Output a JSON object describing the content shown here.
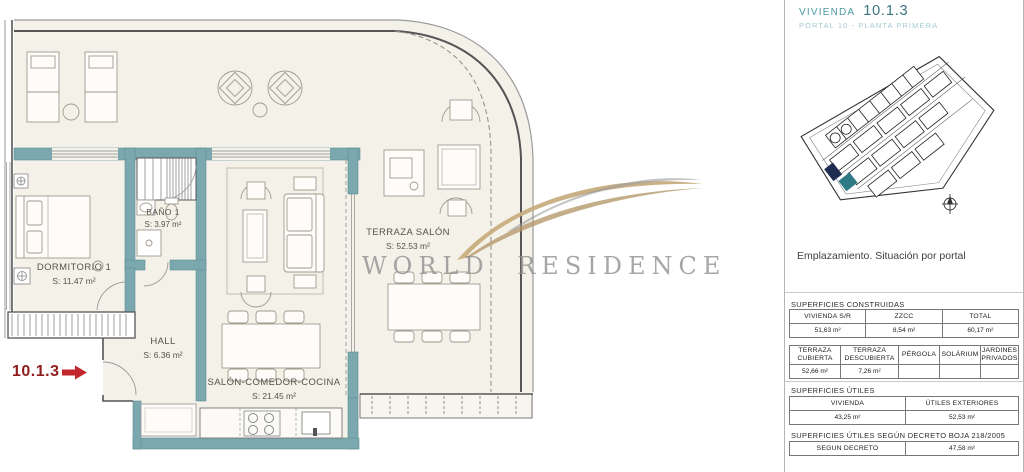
{
  "header": {
    "title_label": "VIVIENDA",
    "unit_number": "10.1.3",
    "subtitle": "PORTAL 10 - PLANTA PRIMERA"
  },
  "site_map": {
    "caption": "Emplazamiento. Situación por portal"
  },
  "surfaces": {
    "construidas": {
      "heading": "SUPERFICIES CONSTRUIDAS",
      "main": {
        "headers": [
          "VIVIENDA S/R",
          "ZZCC",
          "TOTAL"
        ],
        "values": [
          "51,63 m²",
          "8,54 m²",
          "60,17 m²"
        ]
      },
      "exterior": {
        "headers": [
          "TERRAZA CUBIERTA",
          "TERRAZA DESCUBIERTA",
          "PÉRGOLA",
          "SOLÁRIUM",
          "JARDINES PRIVADOS"
        ],
        "values": [
          "52,66 m²",
          "7,26 m²",
          "",
          "",
          ""
        ]
      }
    },
    "utiles": {
      "heading": "SUPERFICIES ÚTILES",
      "table": {
        "headers": [
          "VIVIENDA",
          "ÚTILES EXTERIORES"
        ],
        "values": [
          "43,25 m²",
          "52,53 m²"
        ]
      }
    },
    "decreto": {
      "heading": "SUPERFICIES ÚTILES SEGÚN DECRETO BOJA 218/2005",
      "table": {
        "headers": [
          "SEGUN DECRETO"
        ],
        "values": [
          "47,58 m²"
        ]
      }
    }
  },
  "plan": {
    "unit_label": "10.1.3",
    "rooms": [
      {
        "name": "DORMITORIO 1",
        "area": "S: 11.47 m²"
      },
      {
        "name": "BAÑO 1",
        "area": "S: 3.97 m²"
      },
      {
        "name": "HALL",
        "area": "S: 6.36 m²"
      },
      {
        "name": "SALÓN-COMEDOR-COCINA",
        "area": "S: 21.45 m²"
      },
      {
        "name": "TERRAZA SALÓN",
        "area": "S: 52.53 m²"
      }
    ]
  },
  "watermark": {
    "brand": "WORLD RESIDENCE"
  },
  "colors": {
    "wall_teal": "#7BA8AE",
    "plan_background": "#F4F1E8",
    "arrow_red": "#C1272D",
    "unit_red": "#8F1D1D",
    "title_teal": "#4B99A4",
    "subtitle_teal": "#A5CBD1",
    "watermark_gray": "#909090",
    "watermark_gold": "#C6AD7E",
    "map_highlight_teal": "#2E7A85",
    "map_highlight_navy": "#1E2D50"
  }
}
